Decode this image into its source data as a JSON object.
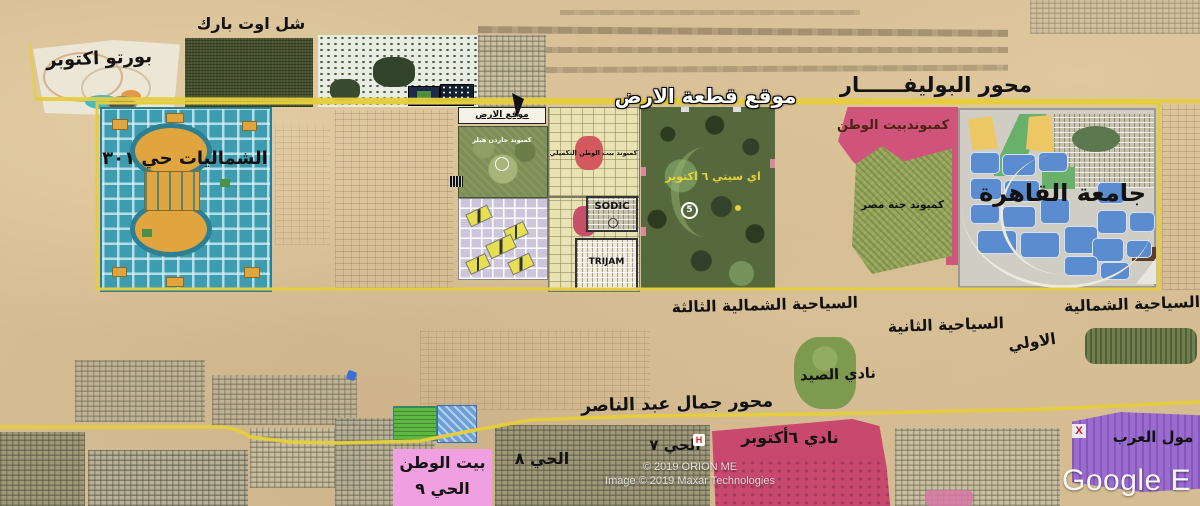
{
  "labels": {
    "porto_october": "بورتو اكتوبر",
    "chill_out_park": "شل اوت بارك",
    "boulevard_axis": "محور البوليفــــــار",
    "plot_title": "موقع قطعة الارض",
    "plot_box": "موقع الارض",
    "shamaliat": "الشماليات حي ٣٠١",
    "garden_hills": "كمبوند جاردن هيلز",
    "beit_watan_takmili": "كمبوند بيت الوطن التكميلي",
    "sodic": "SODIC",
    "trijam": "TRIJAM",
    "icity": "اي سيتي ٦ اكتوبر",
    "icity_marker": "5",
    "beit_watan": "كمبوندبيت الوطن",
    "janna_misr": "كمبوند جنة مصر",
    "cairo_university": "جامعة القاهرة",
    "tourist_third": "السياحية الشمالية الثالثة",
    "tourist_second": "السياحية الثانية",
    "tourist_first_line1": "السياحية الشمالية",
    "tourist_first_line2": "الاولي",
    "hunting_club": "نادي الصيد",
    "nasser_axis": "محور جمال عبد الناصر",
    "october_club": "نادي ٦أكتوبر",
    "arab_mall": "مول العرب",
    "beit_watan9_line1": "بيت الوطن",
    "beit_watan9_line2": "الحي ٩",
    "district_8": "الحي ٨",
    "district_7": "الحي ٧",
    "hospital_marker": "H",
    "mall_marker": "X"
  },
  "watermark": {
    "google": "Google E",
    "copyright_1": "© 2019 ORION ME",
    "copyright_2": "Image © 2019 Maxar Technologies"
  },
  "colors": {
    "road_yellow": "#e5ce3e",
    "compound_pink": "#d0537c",
    "club_pink": "#c9486d",
    "mall_purple": "#9a6cd0",
    "label_pink": "#f0a0e0",
    "shamaliat_teal": "#3e9cb0",
    "university_blue": "#5b8cd0",
    "janna_green": "#97a75a"
  }
}
